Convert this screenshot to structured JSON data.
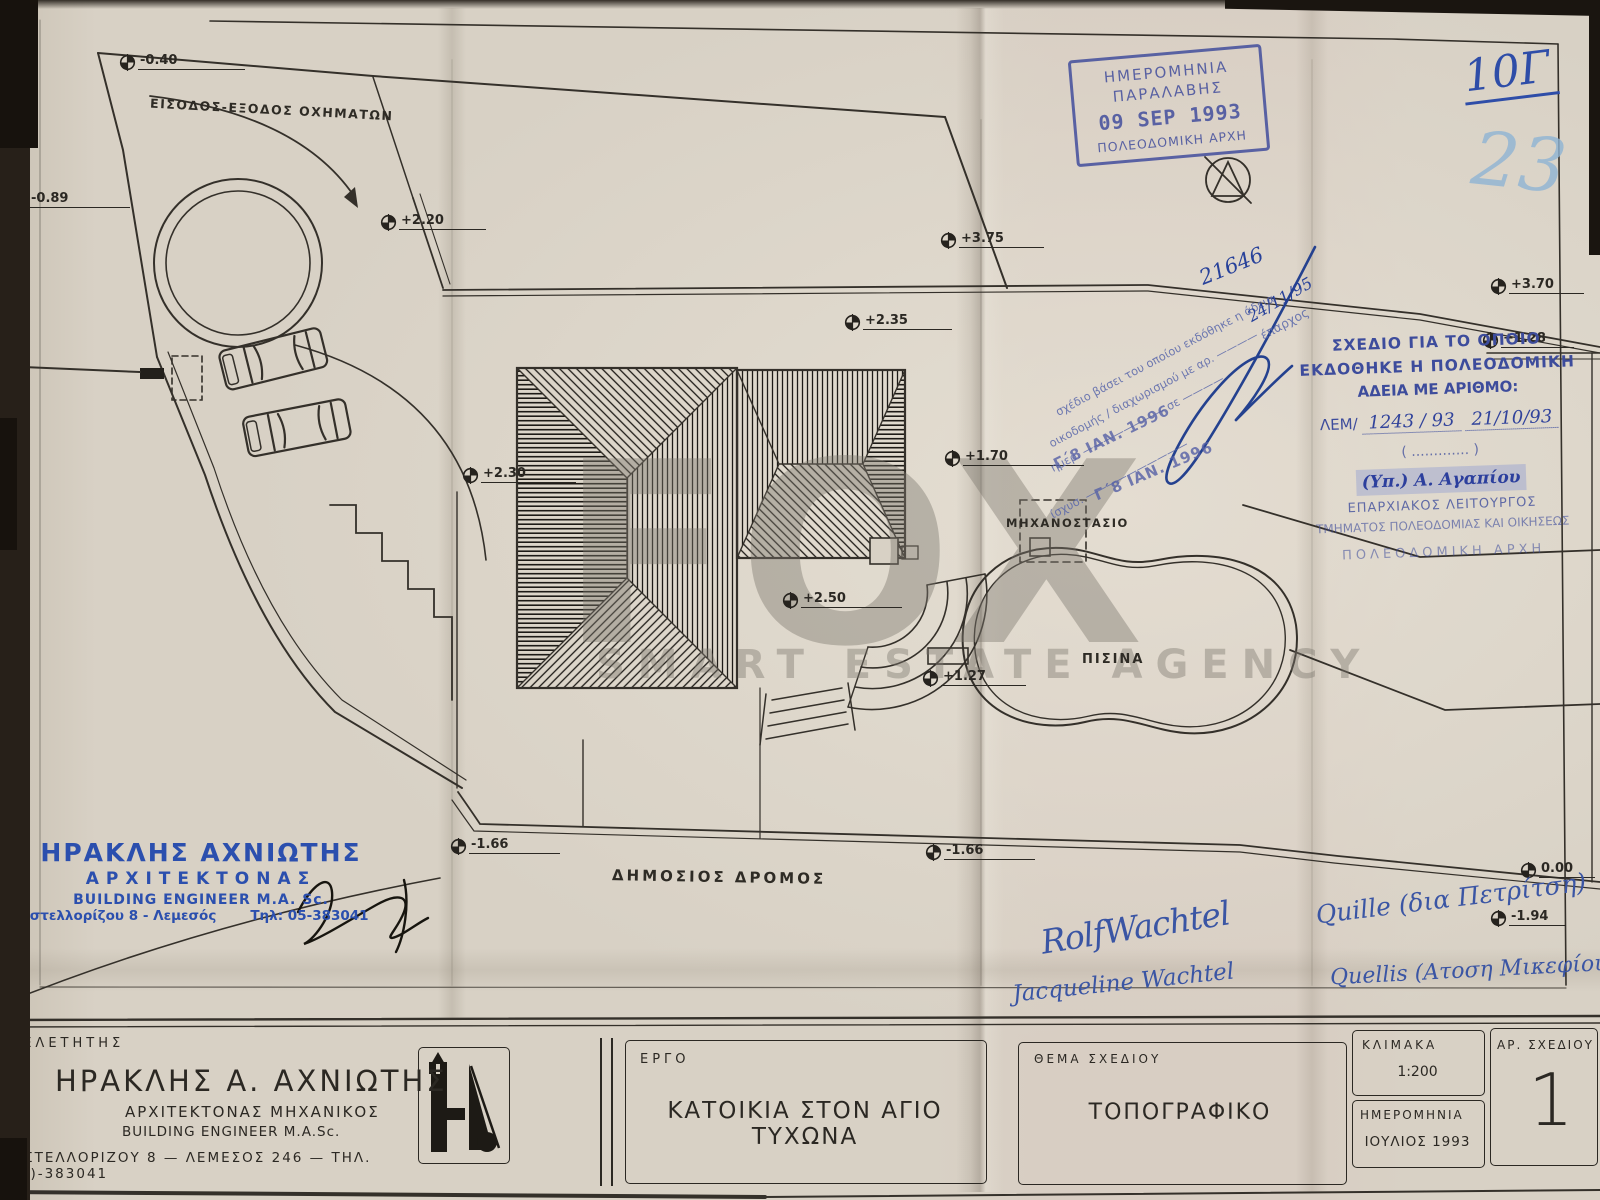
{
  "sheet": {
    "watermark_brand": "FOX",
    "watermark_tagline": "SMART ESTATE AGENCY",
    "handwritten_sheet_code": "10Γ",
    "handwritten_page_number": "23"
  },
  "receipt_stamp": {
    "line1": "ΗΜΕΡΟΜΗΝΙΑ",
    "line2": "ΠΑΡΑΛΑΒΗΣ",
    "date": "09 SEP 1993",
    "line4": "ΠΟΛΕΟΔΟΜΙΚΗ ΑΡΧΗ"
  },
  "permit_stamp": {
    "line1": "ΣΧΕΔΙΟ ΓΙΑ ΤΟ ΟΠΟΙΟ",
    "line2": "ΕΚΔΟΘΗΚΕ Η ΠΟΛΕΟΔΟΜΙΚΗ",
    "line3": "ΑΔΕΙΑ ΜΕ ΑΡΙΘΜΟ:",
    "ref_prefix": "ΛΕΜ/",
    "ref_number": "1243 / 93",
    "ref_date": "21/10/93",
    "paren": "( ............. )",
    "signed_by": "(Υπ.) Α. Αγαπίου",
    "title1": "ΕΠΑΡΧΙΑΚΟΣ ΛΕΙΤΟΥΡΓΟΣ",
    "title2": "ΤΜΗΜΑΤΟΣ ΠΟΛΕΟΔΟΜΙΑΣ ΚΑΙ ΟΙΚΗΣΕΩΣ",
    "title3": "ΠΟΛΕΟΔΟΜΙΚΗ ΑΡΧΗ"
  },
  "note_stamp": {
    "line1": "σχέδιο βάσει του οποίου εκδόθηκε η άδεια",
    "line2": "οικοδομής / διαχωρισμού με αρ. ————",
    "line3": "ημερ. ———————— σε ————",
    "line4": "ίσχυσ. ——————————",
    "date_stamp1": "Γ΄8 ΙΑΝ. 1996",
    "date_stamp2": "Γ΄8 ΙΑΝ. 1996",
    "eparxos": "έπαρχος",
    "hw_number": "21646",
    "hw_date": "24/11/95"
  },
  "plan_labels": {
    "entrance": "ΕΙΣΟΔΟΣ-ΕΞΟΔΟΣ ΟΧΗΜΑΤΩΝ",
    "machine_room": "ΜΗΧΑΝΟΣΤΑΣΙΟ",
    "pool": "ΠΙΣΙΝΑ",
    "public_road": "ΔΗΜΟΣΙΟΣ ΔΡΟΜΟΣ"
  },
  "markers": [
    {
      "value": "-0.40"
    },
    {
      "value": "-0.89"
    },
    {
      "value": "+2.20"
    },
    {
      "value": "+3.75"
    },
    {
      "value": "+2.35"
    },
    {
      "value": "+3.70"
    },
    {
      "value": "+1.28"
    },
    {
      "value": "+2.30"
    },
    {
      "value": "+1.70"
    },
    {
      "value": "+2.50"
    },
    {
      "value": "+1.27"
    },
    {
      "value": "-1.66"
    },
    {
      "value": "-1.66"
    },
    {
      "value": "0.00"
    },
    {
      "value": "-1.94"
    }
  ],
  "architect_stamp": {
    "name": "ΗΡΑΚΛΗΣ ΑΧΝΙΩΤΗΣ",
    "role": "ΑΡΧΙΤΕΚΤΟΝΑΣ",
    "role_en": "BUILDING ENGINEER M.A. Sc.",
    "address": "Καστελλορίζου 8 - Λεμεσός",
    "phone": "Τηλ: 05-383041"
  },
  "signatures": {
    "sig1": "RolfWachtel",
    "sig2": "Jacqueline Wachtel",
    "sig3": "Quille (δια Πετρίτση)",
    "sig4": "Quellis (Ατοση Μικεφίου)"
  },
  "title_block": {
    "designer_label": "ΜΕΛΕΤΗΤΗΣ",
    "designer_name": "ΗΡΑΚΛΗΣ Α. ΑΧΝΙΩΤΗΣ",
    "designer_role": "ΑΡΧΙΤΕΚΤΟΝΑΣ ΜΗΧΑΝΙΚΟΣ",
    "designer_role_en": "BUILDING ENGINEER M.A.Sc.",
    "designer_address": "ΚΑΣΤΕΛΛΟΡΙΖΟΥ 8 — ΛΕΜΕΣΟΣ 246 — ΤΗΛ. (05)-383041",
    "project_label": "ΕΡΓΟ",
    "project_name": "ΚΑΤΟΙΚΙΑ ΣΤΟΝ ΑΓΙΟ ΤΥΧΩΝΑ",
    "subject_label": "ΘΕΜΑ ΣΧΕΔΙΟΥ",
    "subject_value": "ΤΟΠΟΓΡΑΦΙΚΟ",
    "scale_label": "ΚΛΙΜΑΚΑ",
    "scale_value": "1:200",
    "date_label": "ΗΜΕΡΟΜΗΝΙΑ",
    "date_value": "ΙΟΥΛΙΟΣ 1993",
    "number_label": "ΑΡ. ΣΧΕΔΙΟΥ",
    "number_value": "1"
  }
}
